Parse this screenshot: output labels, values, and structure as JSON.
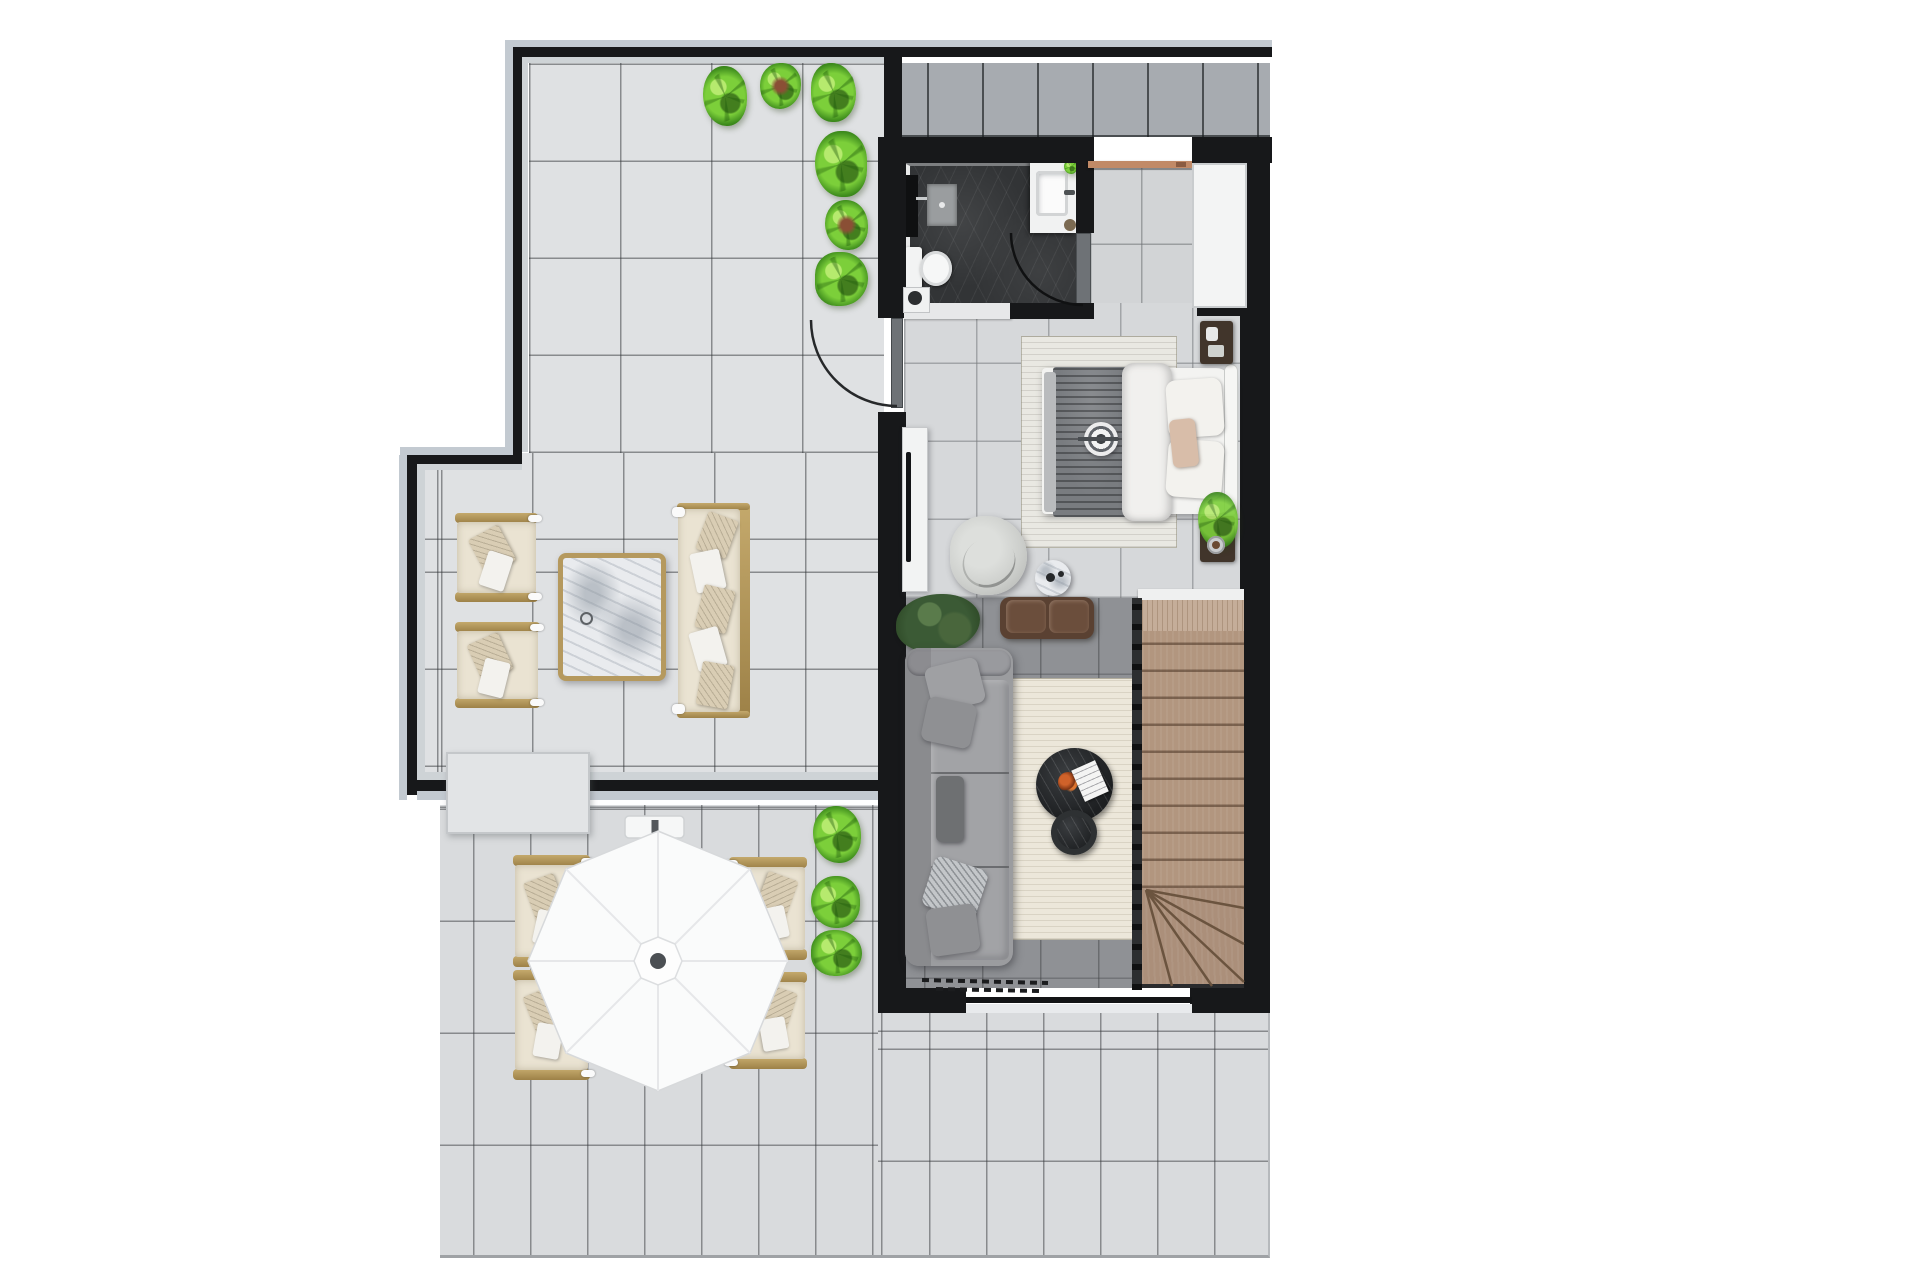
{
  "scene": {
    "kind": "floor-plan-3d-render",
    "view": "top-down",
    "level_label": "upper floor with wraparound terrace",
    "visible_text": "none"
  },
  "palette": {
    "page-bg": "#ffffff",
    "wall-core": "#17181a",
    "wall-edge": "#c3cad1",
    "tile-terrace": "#dfe1e3",
    "tile-lower": "#d9dbdd",
    "tile-strip": "#a7abb0",
    "tile-interior": "#d6d8da",
    "floor-living": "#8f9195",
    "bath-floor": "#323436",
    "copper-door": "#c18a67",
    "frame-tan": "#b5995e",
    "cushion-cream": "#eae3d2",
    "pillow-pattern": "#d9cdb4",
    "sofa-gray": "#9b9c9f",
    "rug-living": "#ece7da",
    "rug-bedroom": "#e9e8e2",
    "stair-wood": "#b2967f",
    "stair-landing": "#c5ad99",
    "bench-leather": "#5a4132",
    "table-black": "#232527",
    "green-light": "#7ccf3a",
    "green-dark": "#3e8c1d",
    "green-deep": "#3b5a35",
    "blanket-gray": "#797c80",
    "umbrella-white": "#fafbfb",
    "accent-flower": "#d0622a",
    "blush": "#d8bda9"
  },
  "rooms": {
    "upper_terrace": {
      "label": "Terrace lounge",
      "furniture": [
        "armchair",
        "armchair",
        "marble coffee table",
        "outdoor sofa",
        "planter bushes",
        "storage counter"
      ]
    },
    "lower_terrace": {
      "label": "Terrace dining",
      "furniture": [
        "cantilever umbrella",
        "dining chair x4",
        "planter bushes"
      ]
    },
    "walkway": {
      "label": "Top walkway",
      "furniture": []
    },
    "bathroom": {
      "label": "Bathroom",
      "furniture": [
        "shower",
        "toilet",
        "vanity sink",
        "door"
      ]
    },
    "entry_hall": {
      "label": "Entry hall",
      "furniture": [
        "copper entry door",
        "wardrobe"
      ]
    },
    "bedroom": {
      "label": "Bedroom",
      "furniture": [
        "double bed",
        "rug",
        "nightstand x2",
        "tv unit",
        "swivel chair",
        "side table"
      ]
    },
    "living_room": {
      "label": "Living room",
      "furniture": [
        "gray sofa",
        "rug",
        "round coffee table x2",
        "leather bench",
        "fiddle-leaf plant",
        "sliding door"
      ]
    },
    "staircase": {
      "label": "Staircase",
      "furniture": [
        "landing",
        "straight flight",
        "winder treads"
      ]
    }
  }
}
